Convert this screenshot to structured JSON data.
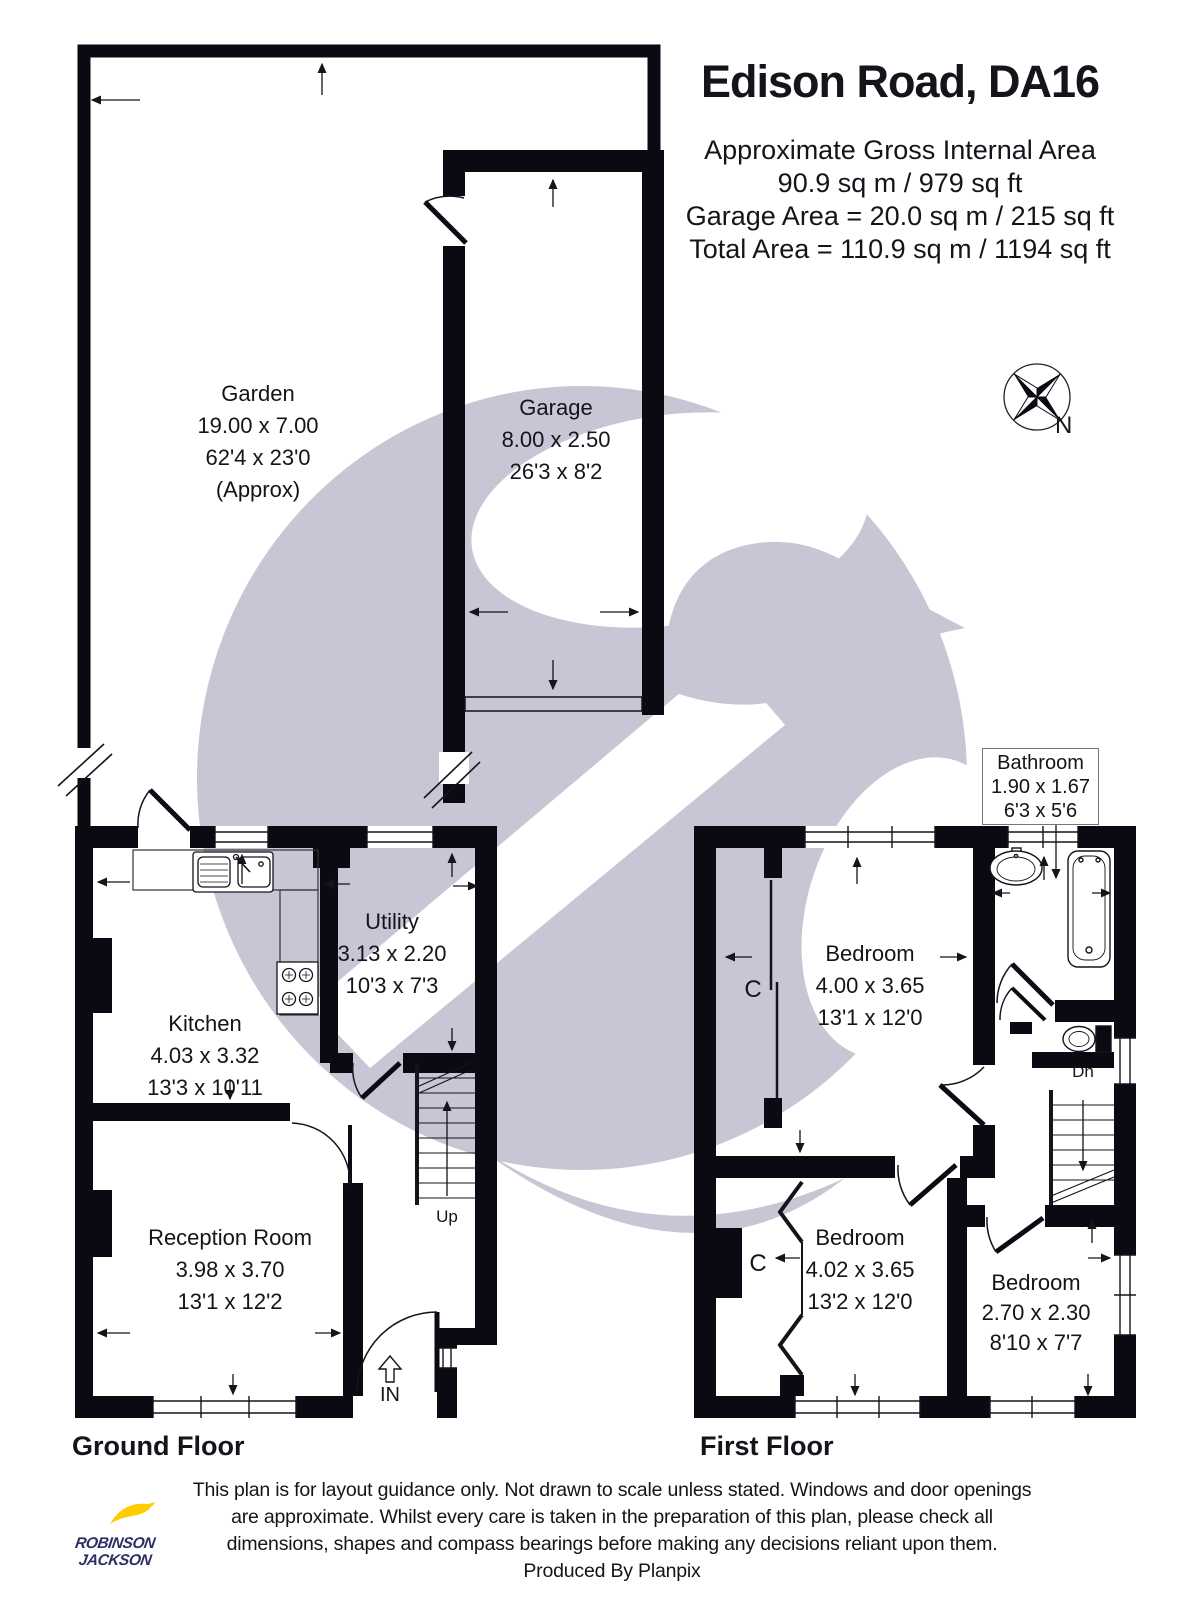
{
  "header": {
    "title": "Edison Road, DA16",
    "area_lines": [
      "Approximate Gross Internal Area",
      "90.9 sq m / 979 sq ft",
      "Garage Area = 20.0 sq m / 215 sq ft",
      "Total Area = 110.9 sq m / 1194 sq ft"
    ]
  },
  "compass": {
    "north_label": "N"
  },
  "rooms": {
    "garden": {
      "name": "Garden",
      "metric": "19.00 x 7.00",
      "imperial": "62'4 x 23'0",
      "note": "(Approx)"
    },
    "garage": {
      "name": "Garage",
      "metric": "8.00 x 2.50",
      "imperial": "26'3 x 8'2"
    },
    "kitchen": {
      "name": "Kitchen",
      "metric": "4.03 x 3.32",
      "imperial": "13'3 x 10'11"
    },
    "utility": {
      "name": "Utility",
      "metric": "3.13 x 2.20",
      "imperial": "10'3 x 7'3"
    },
    "reception": {
      "name": "Reception Room",
      "metric": "3.98 x 3.70",
      "imperial": "13'1 x 12'2"
    },
    "bathroom": {
      "name": "Bathroom",
      "metric": "1.90 x 1.67",
      "imperial": "6'3 x 5'6"
    },
    "bedroom1": {
      "name": "Bedroom",
      "metric": "4.00 x 3.65",
      "imperial": "13'1 x 12'0"
    },
    "bedroom2": {
      "name": "Bedroom",
      "metric": "4.02 x 3.65",
      "imperial": "13'2 x 12'0"
    },
    "bedroom3": {
      "name": "Bedroom",
      "metric": "2.70 x 2.30",
      "imperial": "8'10 x 7'7"
    }
  },
  "annotations": {
    "up": "Up",
    "down": "Dn",
    "entrance": "IN",
    "cupboard": "C"
  },
  "floors": {
    "ground": "Ground Floor",
    "first": "First Floor"
  },
  "footer": {
    "disclaimer_lines": [
      "This plan is for layout guidance only. Not drawn to scale unless stated. Windows and door openings",
      "are approximate. Whilst every care is taken in the preparation of this plan, please check all",
      "dimensions, shapes and compass bearings before making any decisions reliant upon them."
    ],
    "produced_by": "Produced By Planpix"
  },
  "logo": {
    "line1": "ROBINSON",
    "line2": "JACKSON"
  },
  "colors": {
    "wall": "#0a0a12",
    "watermark": "#c7c6d4",
    "logo_navy": "#2e3063",
    "logo_yellow": "#ffcc00",
    "text": "#14141a"
  }
}
